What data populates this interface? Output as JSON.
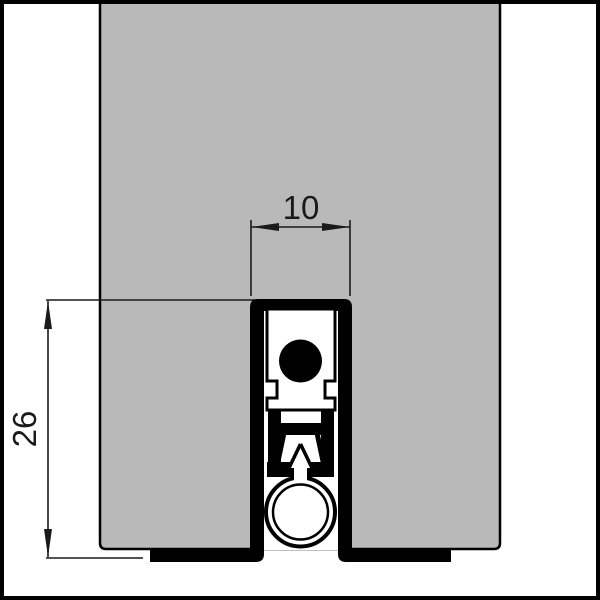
{
  "colors": {
    "background": "#ffffff",
    "outline": "#000000",
    "door_fill": "#b9b9b9",
    "profile_fill": "#000000",
    "cavity_fill": "#ffffff",
    "dimension_color": "#1a1a1a"
  },
  "annotations": {
    "width_dim": "10",
    "height_dim": "26"
  }
}
